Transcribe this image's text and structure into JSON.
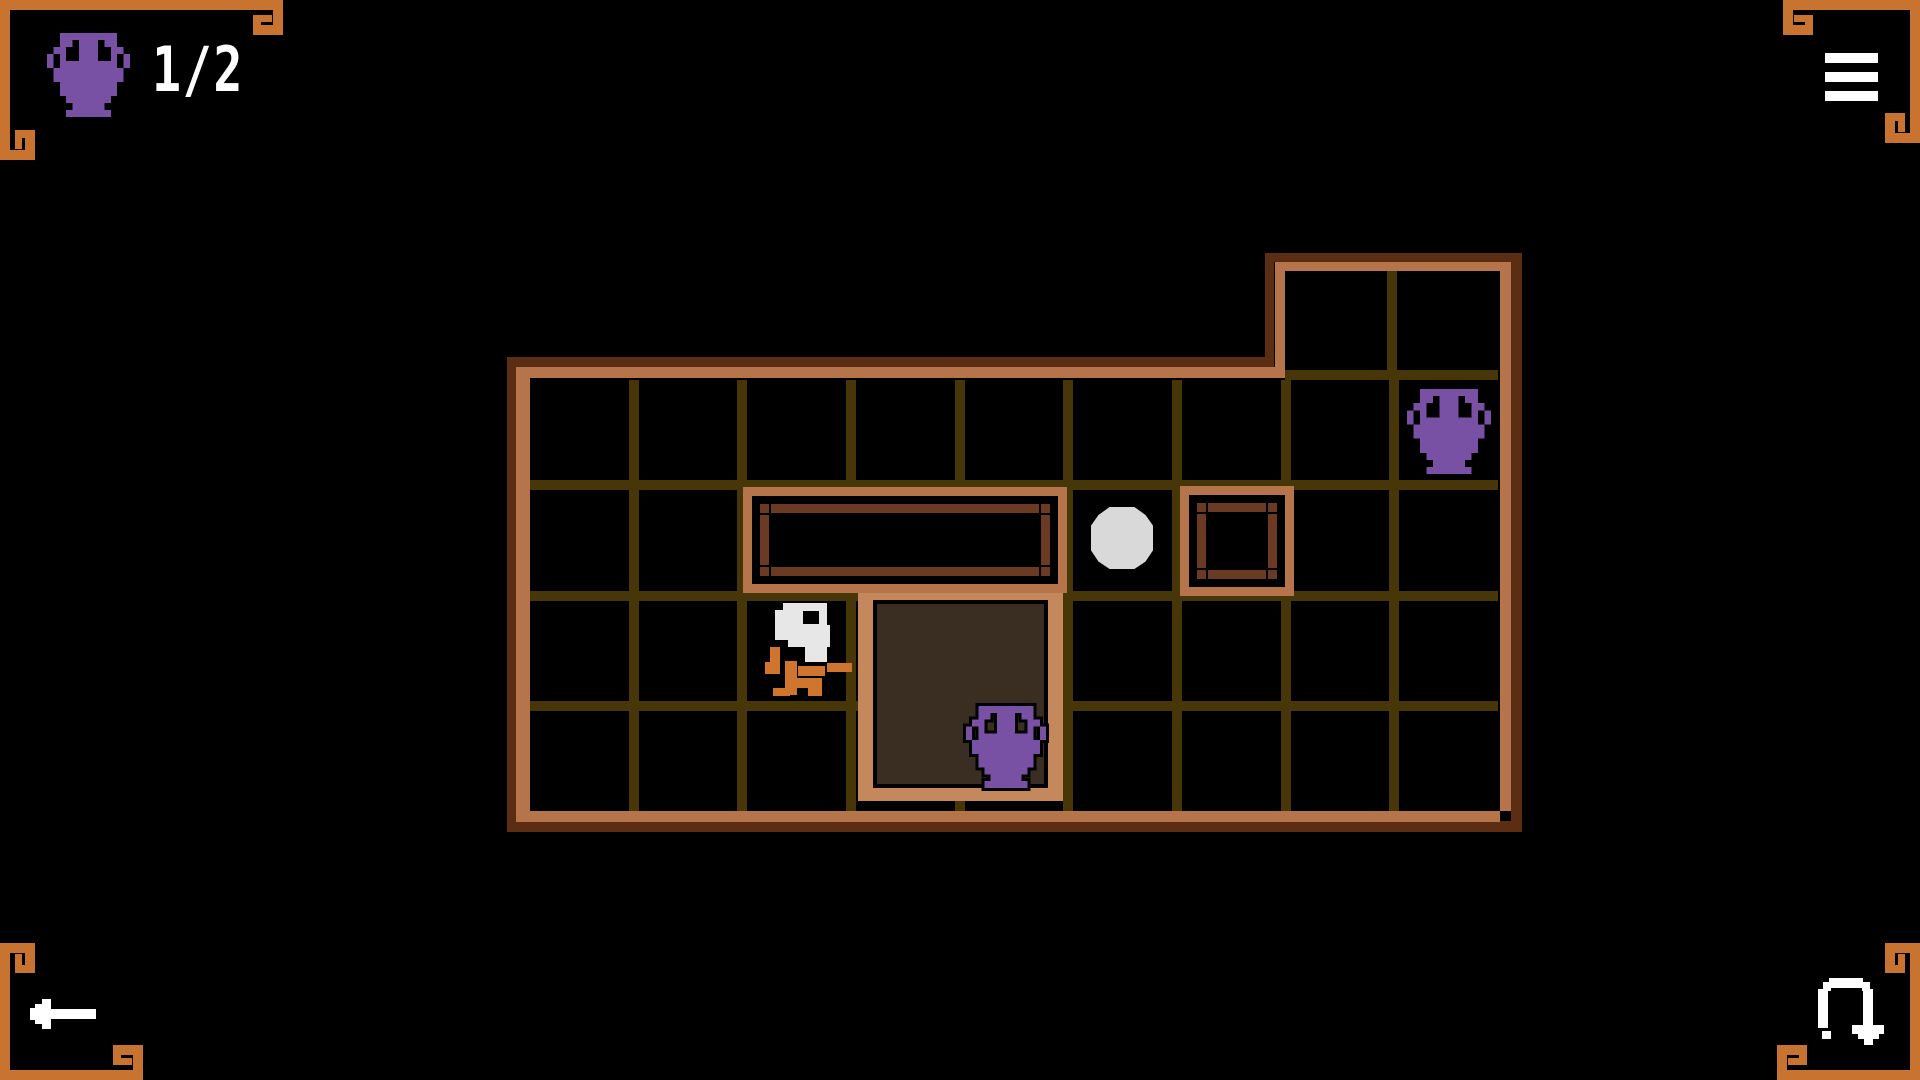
{
  "hud": {
    "counter_value": "1/2",
    "counter_icon": "amphora-icon",
    "menu_icon": "menu-icon",
    "back_icon": "back-arrow-icon",
    "restart_icon": "restart-icon"
  },
  "colors": {
    "orange": "#c8732f",
    "tan": "#b5744a",
    "pit_tan": "#c5885c",
    "outline": "#5b2d13",
    "grid": "#473708",
    "floor": "#3a2e23",
    "purple": "#7850a4",
    "ball": "#d9d9d9",
    "white": "#ffffff",
    "player_orange": "#d0752e",
    "player_white": "#e7e7e7",
    "walnut": "#6b3a22"
  },
  "board": {
    "grid": {
      "main": {
        "x": 530,
        "y": 380,
        "w": 968,
        "h": 431,
        "cols": 9,
        "rows": 4
      },
      "extension": {
        "x": 1285,
        "y": 271,
        "w": 213,
        "h": 109,
        "cols": 2,
        "rows": 1
      }
    },
    "entities": [
      {
        "type": "pit",
        "name": "pit",
        "x": 858,
        "y": 592,
        "w": 205,
        "h": 209,
        "interactable": false
      },
      {
        "type": "wall",
        "name": "wall-block-wide",
        "x": 743,
        "y": 487,
        "w": 324,
        "h": 106,
        "interactable": false
      },
      {
        "type": "wall",
        "name": "wall-block-small",
        "x": 1180,
        "y": 486,
        "w": 114,
        "h": 110,
        "interactable": false
      },
      {
        "type": "ball",
        "name": "marble-ball",
        "x": 1091,
        "y": 507,
        "w": 62,
        "h": 62,
        "interactable": true
      },
      {
        "type": "amphora",
        "name": "amphora-goal",
        "x": 1407,
        "y": 389,
        "w": 84,
        "h": 85,
        "interactable": true
      },
      {
        "type": "amphora",
        "name": "amphora-in-pit",
        "x": 966,
        "y": 706,
        "w": 80,
        "h": 82,
        "outlined": true,
        "interactable": true
      },
      {
        "type": "player",
        "name": "player-character",
        "x": 763,
        "y": 601,
        "w": 90,
        "h": 95,
        "interactable": true
      }
    ]
  }
}
